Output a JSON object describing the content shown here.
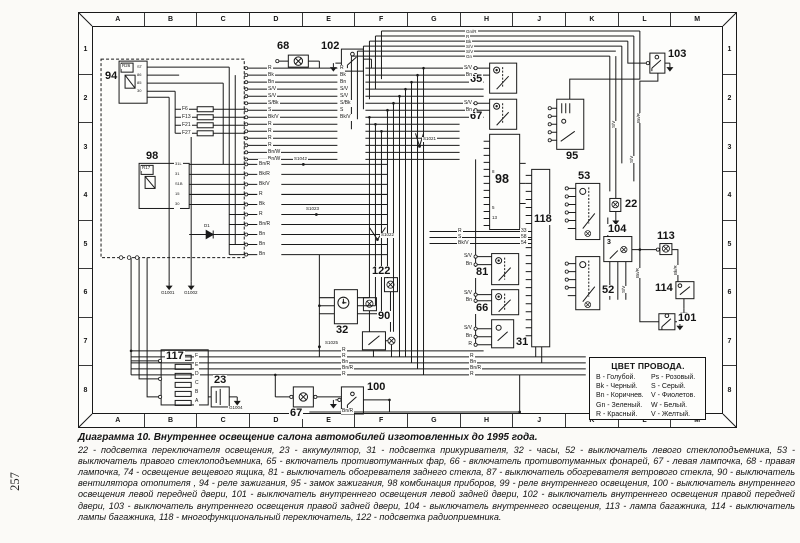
{
  "page": {
    "number": "257"
  },
  "grid": {
    "top": [
      "A",
      "B",
      "C",
      "D",
      "E",
      "F",
      "G",
      "H",
      "J",
      "K",
      "L",
      "M"
    ],
    "bottom": [
      "A",
      "B",
      "C",
      "D",
      "E",
      "F",
      "G",
      "H",
      "J",
      "K",
      "L",
      "M"
    ],
    "left": [
      "1",
      "2",
      "3",
      "4",
      "5",
      "6",
      "7",
      "8"
    ],
    "right": [
      "1",
      "2",
      "3",
      "4",
      "5",
      "6",
      "7",
      "8"
    ]
  },
  "legend": {
    "title": "ЦВЕТ ПРОВОДА.",
    "entries": [
      "B - Голубой.",
      "Ps - Розовый.",
      "Bk - Черный.",
      "S - Серый.",
      "Bn - Коричнев.",
      "V - Фиолетов.",
      "Gn - Зеленый.",
      "W - Белый.",
      "R - Красный.",
      "V - Желтый."
    ]
  },
  "caption": {
    "title": "Диаграмма 10. Внутреннее освещение салона автомобилей изготовленных до 1995 года.",
    "body": "22 - подсветка переключателя освещения, 23 - аккумулятор, 31 - подсветка прикуривателя, 32 - часы, 52 - выключатель левого стеклоподъемника, 53 - выключатель правого стеклоподъемника, 65 - включатель противотуманных фар, 66 - включатель противотуманных фонарей, 67 - левая лампочка, 68 - правая лампочка, 74 - освещение вещевого ящика, 81 - выключатель обогревателя заднего стекла, 87 - выключатель обогревателя ветрового стекла, 90 - выключатель вентилятора отопителя , 94 - реле зажигания, 95 - замок зажигания, 98 комбинация приборов, 99 - реле внутреннего освещения, 100 - выключатель внутреннего освещения левой передней двери, 101 - выключатель внутреннего освещения левой задней двери, 102 - выключатель внутреннего освещения правой передней двери, 103 - выключатель внутреннего освещения правой задней двери, 104 - выключатель внутреннего освещения, 113 - лампа багажника, 114 - выключатель лампы багажника, 118 - многофункциональный переключатель, 122 - подсветка радиоприемника."
  },
  "components": {
    "c94": "94",
    "c98r": "98",
    "c98": "98",
    "c118": "118",
    "c117": "117",
    "c23": "23",
    "c68": "68",
    "c102": "102",
    "c65": "65",
    "c67t": "67",
    "c95": "95",
    "c103": "103",
    "c53": "53",
    "c52": "52",
    "c22": "22",
    "c104": "104",
    "c113": "113",
    "c114": "114",
    "c101": "101",
    "c81": "81",
    "c66": "66",
    "c31": "31",
    "c32": "32",
    "c122": "122",
    "c90": "90",
    "c100": "100",
    "c67b": "67"
  },
  "labels": {
    "r26": "R26",
    "r17": "R17",
    "d1": "D1",
    "num3": "3",
    "pins94": [
      "ST",
      "86",
      "85",
      "30"
    ],
    "pins98r": [
      "31L",
      "31",
      "S1B",
      "15",
      "30"
    ],
    "pins98": {
      "p1": "8",
      "p2": "5",
      "p3": "13"
    },
    "pins118": [
      "33",
      "58",
      "54"
    ],
    "fuses": [
      "F6",
      "F13",
      "F21",
      "F27"
    ],
    "fusebox": [
      "F",
      "E",
      "D",
      "C",
      "B",
      "A"
    ],
    "splices": {
      "s1042": "S1042",
      "s1023": "S1023",
      "s1021": "S1021",
      "s1022": "S1022",
      "s1025": "S1025",
      "g1001": "G1001",
      "g1002": "G1002",
      "g1004": "G1004"
    }
  },
  "wires": {
    "left_col": [
      "R",
      "Bk",
      "Bn",
      "S/V",
      "S/V",
      "S/Bk",
      "S",
      "Bk/V",
      "R",
      "R",
      "R",
      "R",
      "Bn/W",
      "Bn/W"
    ],
    "left_col2": [
      "Bn/R",
      "Bk/R",
      "Bk/V",
      "R",
      "Bk",
      "R",
      "Bn/R",
      "Bn",
      "Bn",
      "Bn"
    ],
    "mid_col": [
      "R",
      "Bk",
      "Bn",
      "S/V",
      "S/V",
      "S/Bk",
      "S",
      "Bk/V"
    ],
    "top_right": [
      "Gn/R",
      "R",
      "Bk",
      "S/V",
      "S/V",
      "Gn"
    ],
    "sw65": [
      "S/V",
      "Bn"
    ],
    "sw67": [
      "S/V",
      "Bn"
    ],
    "sw81": [
      "S/V",
      "Bn"
    ],
    "sw66": [
      "S/V",
      "Bn"
    ],
    "sw31": [
      "S/V",
      "Bn",
      "R"
    ],
    "pins118_wires": [
      "R",
      "S",
      "Bk/V"
    ],
    "bus_left": [
      "R",
      "R",
      "Bn",
      "Bn/R",
      "R"
    ],
    "bus_right": [
      "R",
      "Bn",
      "Bn/R",
      "R"
    ],
    "bnr_bottom": "Bn/R",
    "rot": [
      "S/V",
      "Bn/R",
      "S/V",
      "Bn/R",
      "Bk/R",
      "S/V"
    ]
  }
}
